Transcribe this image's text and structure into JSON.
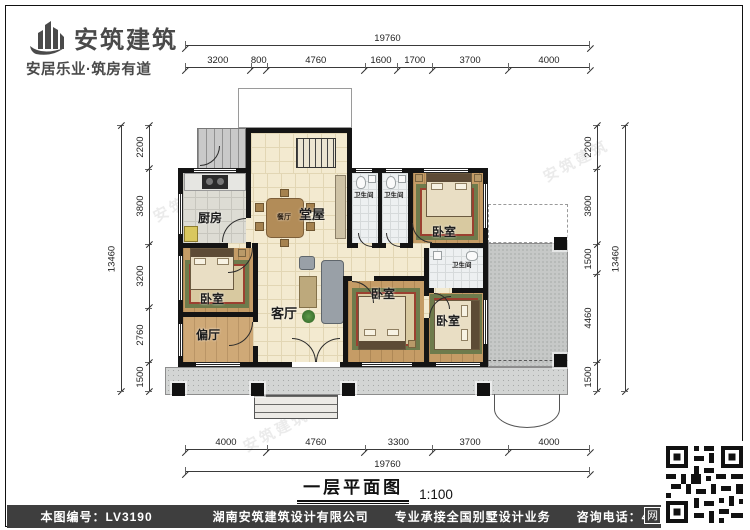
{
  "brand": {
    "name": "安筑建筑",
    "tagline": "安居乐业·筑房有道"
  },
  "title": {
    "text": "一层平面图",
    "scale": "1:100"
  },
  "dimensions": {
    "top": {
      "total": "19760",
      "segments": [
        "3200",
        "800",
        "4760",
        "1600",
        "1700",
        "3700",
        "4000"
      ]
    },
    "bottom": {
      "total": "19760",
      "segments": [
        "4000",
        "4760",
        "3300",
        "3700",
        "4000"
      ]
    },
    "left": {
      "total": "13460",
      "segments": [
        "2200",
        "3800",
        "3200",
        "2760",
        "1500"
      ]
    },
    "right": {
      "total": "13460",
      "segments": [
        "2200",
        "3800",
        "1500",
        "4460",
        "1500"
      ]
    }
  },
  "rooms": [
    {
      "id": "kitchen",
      "label": "厨房"
    },
    {
      "id": "dining",
      "label": "餐厅"
    },
    {
      "id": "hall",
      "label": "堂屋"
    },
    {
      "id": "bath-1",
      "label": "卫生间"
    },
    {
      "id": "bath-2",
      "label": "卫生间"
    },
    {
      "id": "bath-3",
      "label": "卫生间"
    },
    {
      "id": "bedroom-tr",
      "label": "卧室"
    },
    {
      "id": "bedroom-left",
      "label": "卧室"
    },
    {
      "id": "bedroom-mid",
      "label": "卧室"
    },
    {
      "id": "bedroom-br",
      "label": "卧室"
    },
    {
      "id": "living",
      "label": "客厅"
    },
    {
      "id": "side-hall",
      "label": "偏厅"
    }
  ],
  "footer": {
    "number_label": "本图编号：LV3190",
    "company": "湖南安筑建筑设计有限公司",
    "service": "专业承接全国别墅设计业务",
    "phone_label": "咨询电话：400-8070-511",
    "net": "网"
  },
  "watermark": "安筑建筑",
  "colors": {
    "accent_dark": "#3e3e3e",
    "wall": "#141414",
    "floor": "#f3ead0",
    "wood": "#c59c66",
    "patio": "#c6c8c7"
  }
}
